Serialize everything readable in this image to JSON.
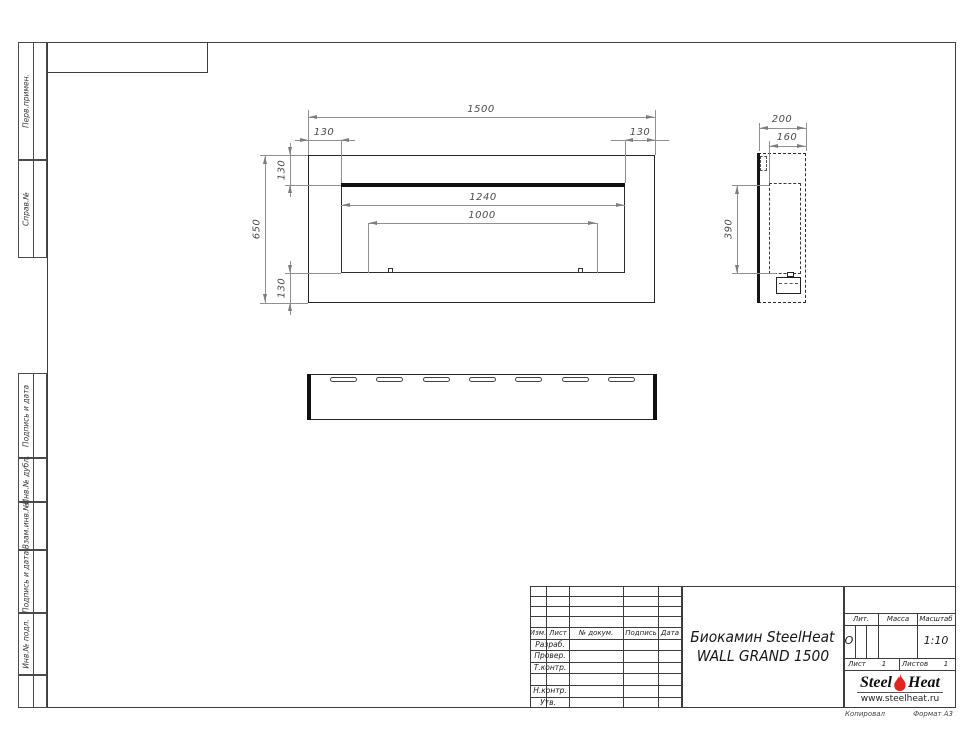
{
  "margin_columns": {
    "sections": [
      {
        "label": "Перв.примен."
      },
      {
        "label": "Справ.№"
      },
      {
        "label": "Подпись и дата"
      },
      {
        "label": "Инв.№ дубл."
      },
      {
        "label": "Взам.инв.№"
      },
      {
        "label": "Подпись и дата"
      },
      {
        "label": "Инв.№ подл."
      },
      {
        "label": ""
      }
    ]
  },
  "views": {
    "front": {
      "dims": {
        "overall_width": "1500",
        "offset_left": "130",
        "offset_right": "130",
        "overall_height": "650",
        "offset_top": "130",
        "offset_bottom": "130",
        "opening_width": "1240",
        "burner_width": "1000"
      }
    },
    "side": {
      "dims": {
        "depth": "200",
        "inner_depth": "160",
        "inner_height": "390"
      }
    },
    "bottom": {
      "slot_count": 7
    }
  },
  "title_block": {
    "header_cols": [
      "Изм.",
      "Лист",
      "№ докум.",
      "Подпись",
      "Дата"
    ],
    "rows": [
      "Разраб.",
      "Провер.",
      "Т.контр.",
      "",
      "Н.контр.",
      "Утв."
    ],
    "title_line1": "Биокамин SteelHeat",
    "title_line2": "WALL GRAND 1500",
    "lit_label": "Лит.",
    "lit_value": "О",
    "mass_label": "Масса",
    "scale_label": "Масштаб",
    "scale_value": "1:10",
    "sheet_label": "Лист",
    "sheet_value": "1",
    "sheets_label": "Листов",
    "sheets_value": "1",
    "logo": {
      "word1": "Steel",
      "word2": "Heat",
      "url": "www.steelheat.ru",
      "flame_color": "#e2251f"
    },
    "footer_left": "Копировал",
    "footer_right": "Формат А3"
  }
}
